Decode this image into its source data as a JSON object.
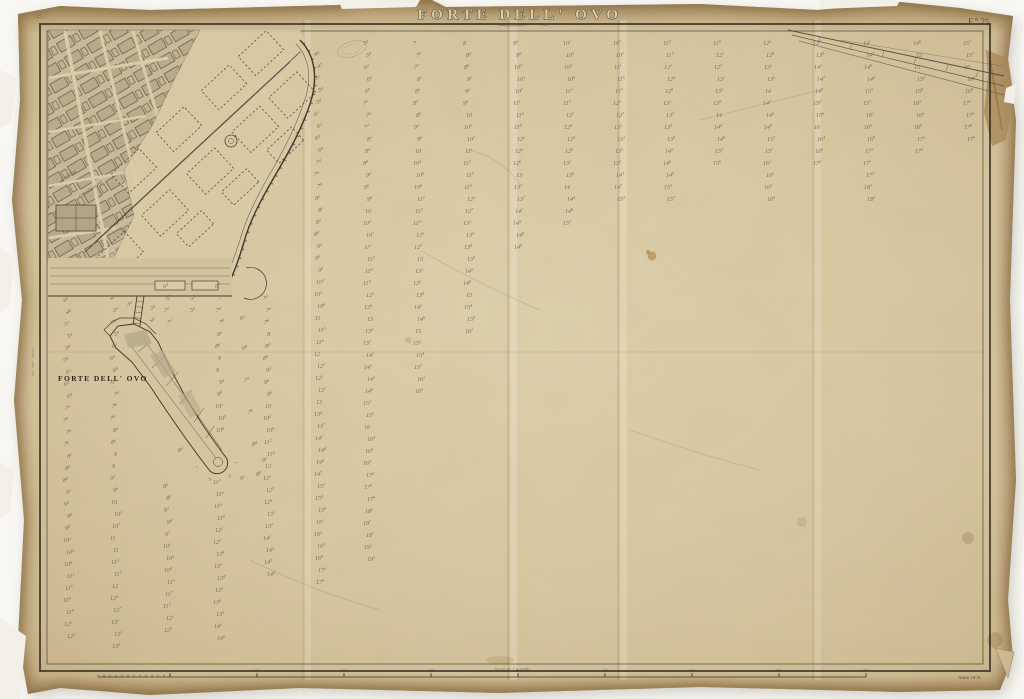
{
  "header": {
    "title": "FORTE DELL' OVO",
    "plate_label": "F.° 25.",
    "corner_mark": "25."
  },
  "labels": {
    "fort_label": "FORTE DELL' OVO",
    "street_1": "S. LUCIA",
    "street_2": "CHIATAMONE",
    "date_note": "Anno 1876"
  },
  "scale": {
    "label": "Scala di 1 a 1000",
    "ticks": [
      "100",
      "200",
      "300",
      "400",
      "500",
      "600",
      "700",
      "800"
    ]
  },
  "palette": {
    "paper": "#d6c7a1",
    "paper_edge": "#b3925f",
    "ink_dark": "#3c352a",
    "ink_mid": "#5a5142",
    "sounding": "#6a5f4d"
  },
  "soundings": {
    "row_spacing": 12,
    "font_size": 6,
    "columns": [
      {
        "x": 65,
        "y0": 302,
        "y1": 632,
        "s": 4.5,
        "e": 12.5
      },
      {
        "x": 112,
        "y0": 300,
        "y1": 644,
        "s": 5.0,
        "e": 13.5
      },
      {
        "x": 165,
        "y0": 288,
        "y1": 324,
        "s": 6.3,
        "e": 7.2
      },
      {
        "x": 165,
        "y0": 488,
        "y1": 632,
        "s": 8.5,
        "e": 12.5
      },
      {
        "x": 217,
        "y0": 288,
        "y1": 432,
        "s": 6.8,
        "e": 10.8
      },
      {
        "x": 215,
        "y0": 484,
        "y1": 644,
        "s": 11.2,
        "e": 14.5
      },
      {
        "x": 265,
        "y0": 300,
        "y1": 576,
        "s": 7.0,
        "e": 15.0
      },
      {
        "x": 316,
        "y0": 56,
        "y1": 580,
        "s": 4.5,
        "e": 17.5
      },
      {
        "x": 365,
        "y0": 45,
        "y1": 556,
        "s": 5.5,
        "e": 19.5
      },
      {
        "x": 415,
        "y0": 45,
        "y1": 392,
        "s": 7.0,
        "e": 16.5
      },
      {
        "x": 465,
        "y0": 45,
        "y1": 332,
        "s": 8.0,
        "e": 16.0
      },
      {
        "x": 515,
        "y0": 45,
        "y1": 252,
        "s": 9.5,
        "e": 15.0
      },
      {
        "x": 565,
        "y0": 45,
        "y1": 224,
        "s": 10.0,
        "e": 15.0
      },
      {
        "x": 615,
        "y0": 45,
        "y1": 196,
        "s": 10.5,
        "e": 15.0
      },
      {
        "x": 665,
        "y0": 45,
        "y1": 196,
        "s": 11.5,
        "e": 15.5
      },
      {
        "x": 715,
        "y0": 45,
        "y1": 168,
        "s": 12.0,
        "e": 15.5
      },
      {
        "x": 765,
        "y0": 45,
        "y1": 196,
        "s": 12.5,
        "e": 17.0
      },
      {
        "x": 815,
        "y0": 45,
        "y1": 168,
        "s": 13.5,
        "e": 17.0
      },
      {
        "x": 865,
        "y0": 45,
        "y1": 196,
        "s": 14.0,
        "e": 18.5
      },
      {
        "x": 915,
        "y0": 45,
        "y1": 154,
        "s": 14.5,
        "e": 17.5
      },
      {
        "x": 965,
        "y0": 45,
        "y1": 140,
        "s": 15.5,
        "e": 18.0
      }
    ],
    "extra": [
      {
        "x": 150,
        "y": 310,
        "v": "3,8"
      },
      {
        "x": 150,
        "y": 322,
        "v": "4,1"
      },
      {
        "x": 127,
        "y": 306,
        "v": "3,5"
      },
      {
        "x": 190,
        "y": 300,
        "v": "5,2"
      },
      {
        "x": 190,
        "y": 312,
        "v": "5,5"
      },
      {
        "x": 240,
        "y": 320,
        "v": "6,2"
      },
      {
        "x": 242,
        "y": 350,
        "v": "6,8"
      },
      {
        "x": 244,
        "y": 382,
        "v": "7,3"
      },
      {
        "x": 248,
        "y": 414,
        "v": "7,9"
      },
      {
        "x": 252,
        "y": 446,
        "v": "8,4"
      },
      {
        "x": 256,
        "y": 476,
        "v": "8,9"
      },
      {
        "x": 178,
        "y": 452,
        "v": "8,1"
      },
      {
        "x": 240,
        "y": 480,
        "v": "9,1"
      },
      {
        "x": 262,
        "y": 462,
        "v": "9,6"
      }
    ]
  }
}
